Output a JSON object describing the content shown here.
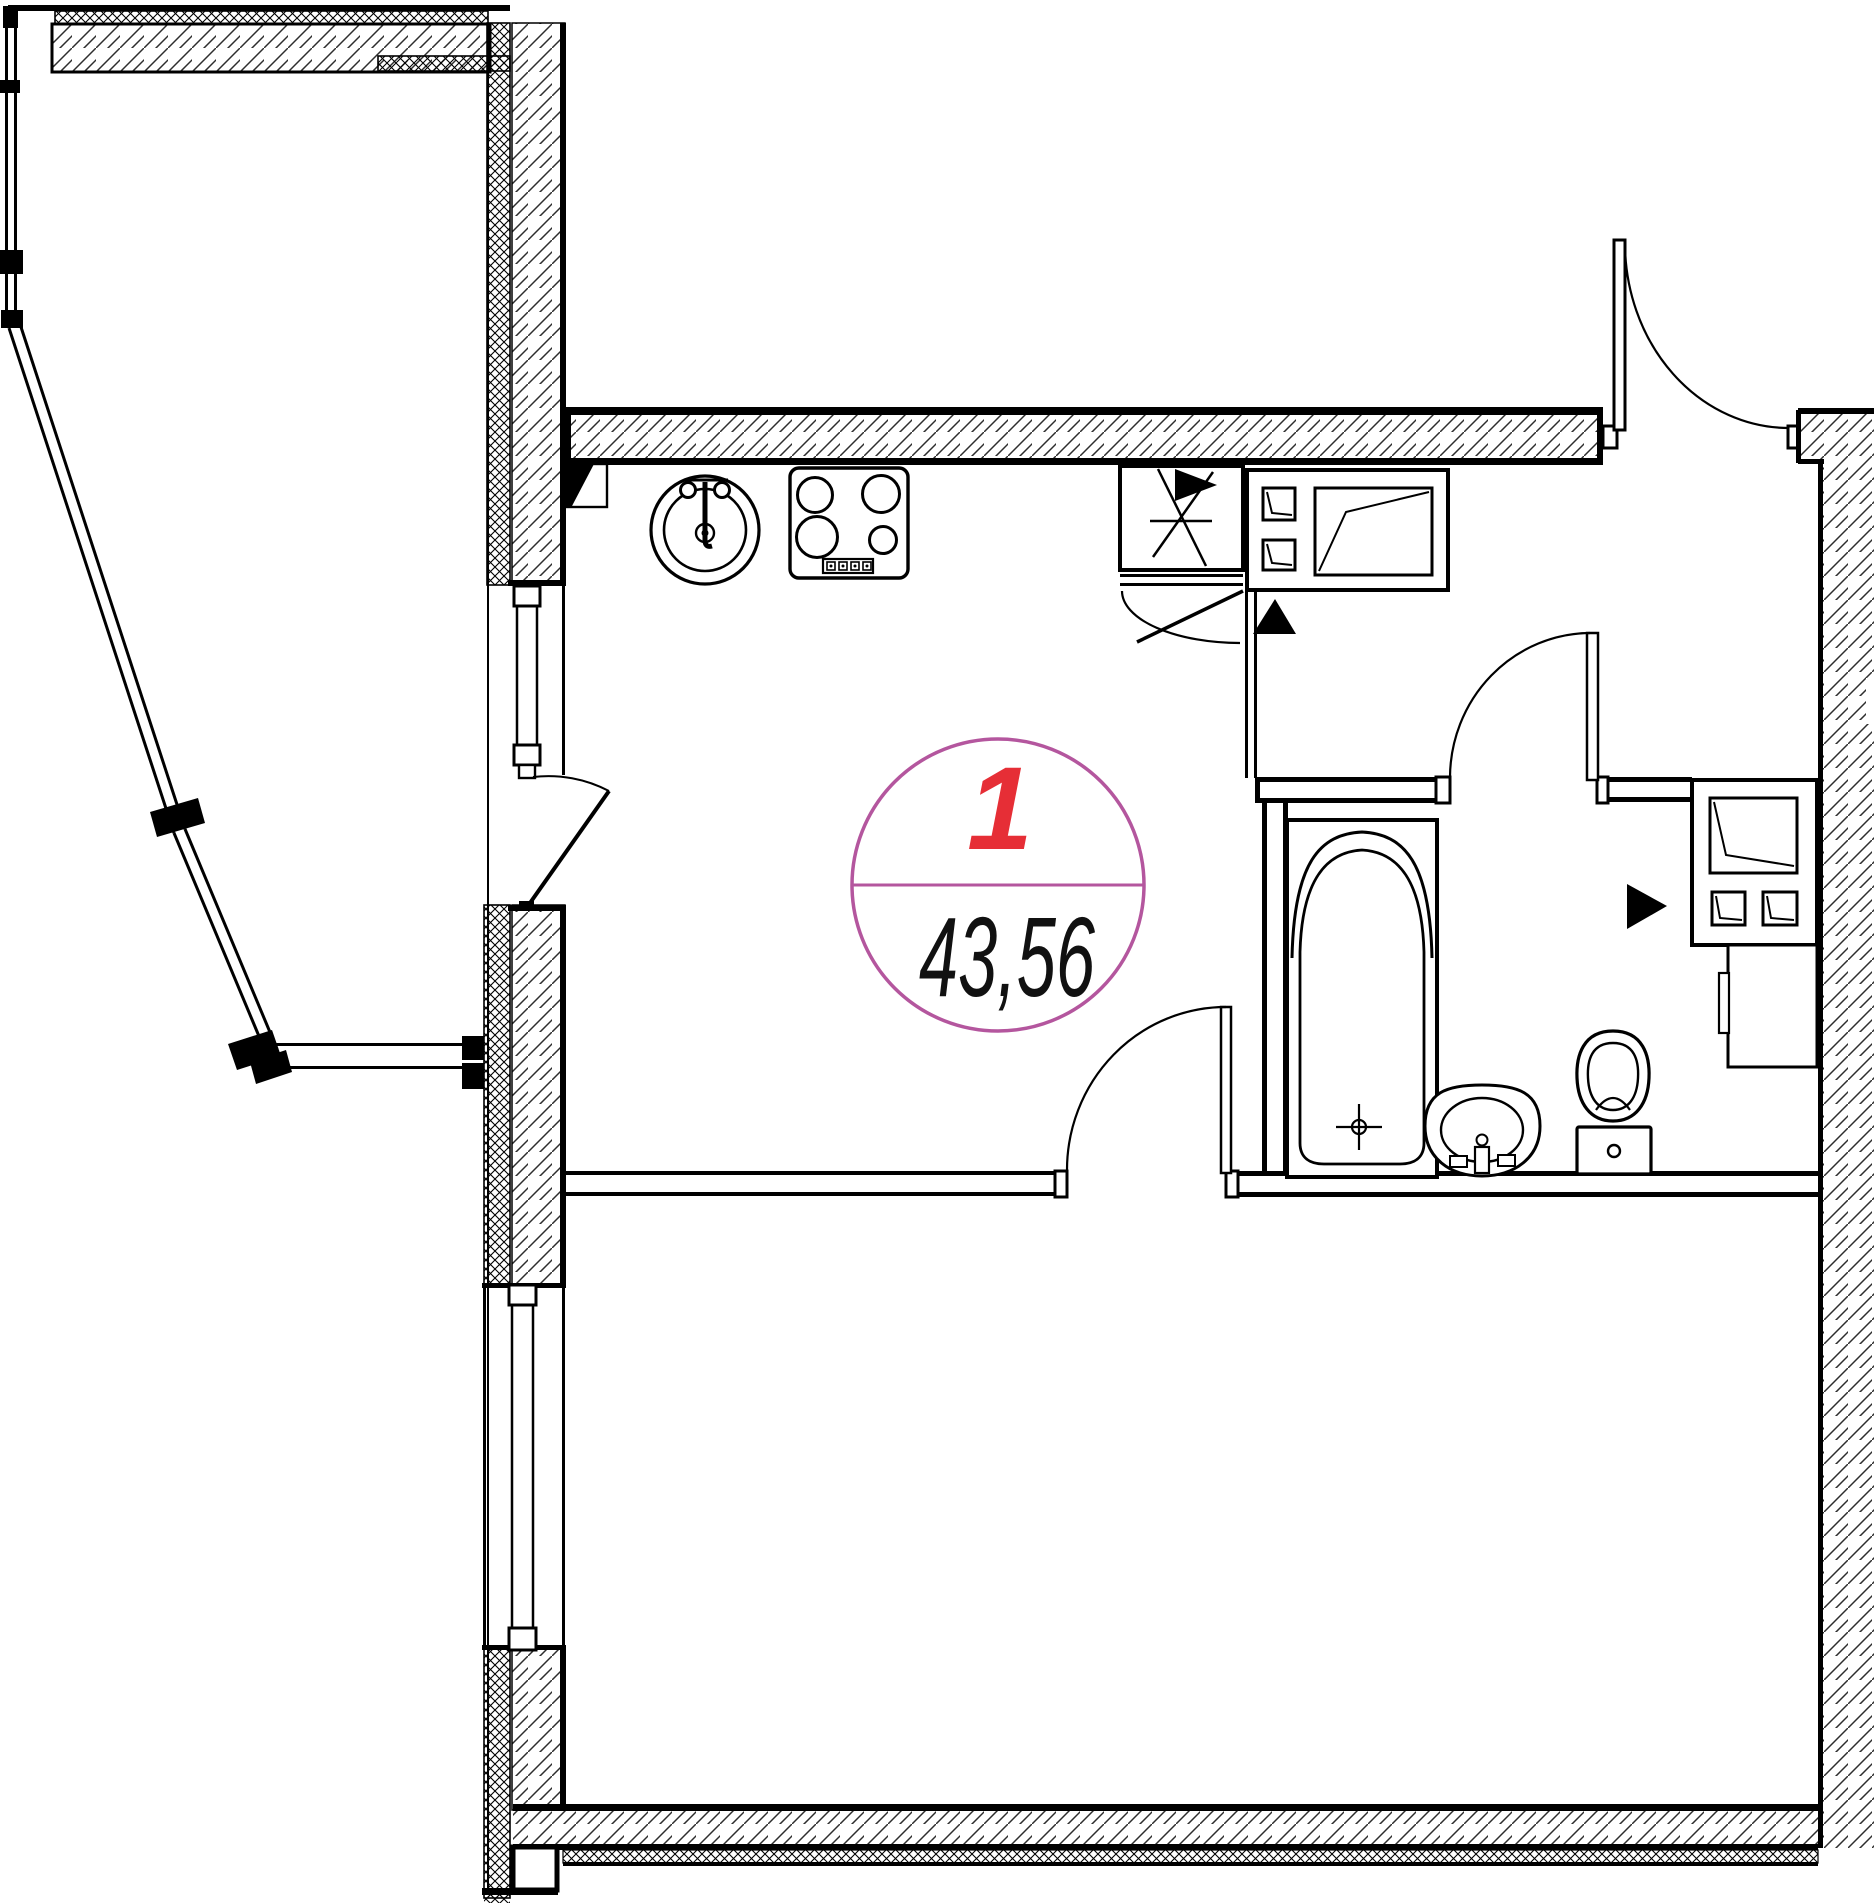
{
  "unit_label": {
    "number": "1",
    "area": "43,56"
  },
  "colors": {
    "label_circle": "#b4569e",
    "unit_number": "#e62e36",
    "area_text": "#111111",
    "line": "#000000"
  },
  "fixtures": [
    "kitchen-sink",
    "cooktop",
    "ventilation-duct",
    "appliance-block",
    "bathtub",
    "washbasin",
    "toilet",
    "utility-shaft",
    "cabinet"
  ]
}
